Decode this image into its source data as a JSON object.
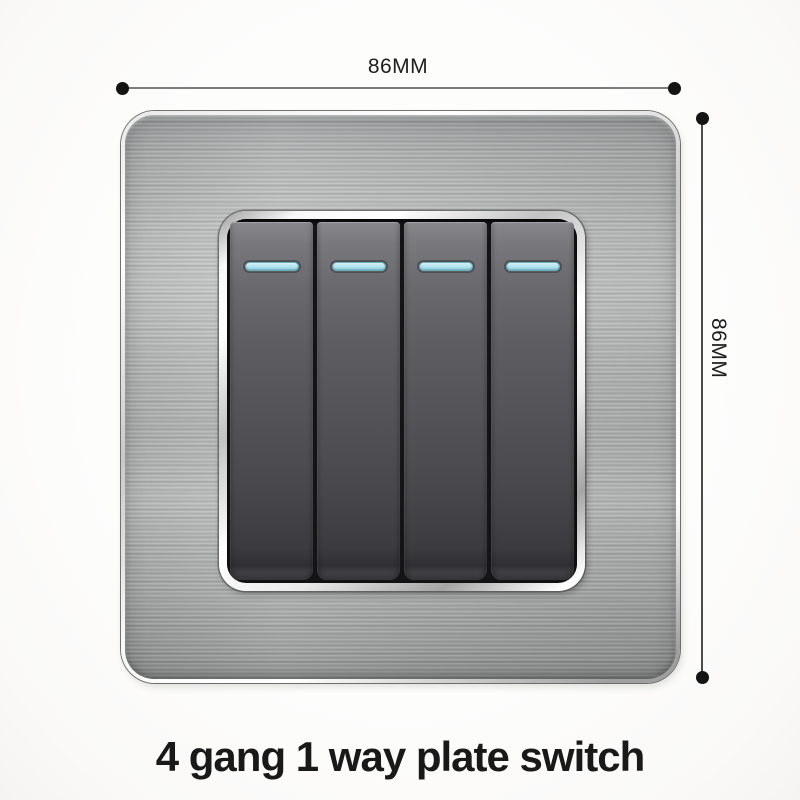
{
  "annotations": {
    "width_label": "86MM",
    "height_label": "86MM"
  },
  "product": {
    "caption": "4 gang 1 way plate switch",
    "gang_count": 4
  },
  "colors": {
    "background": "#fdfdfc",
    "caption_text": "#191919",
    "dimension_text": "#1d1d1d",
    "dimension_line_horizontal": "#7c7c7c",
    "dimension_line_vertical": "#4c4c4c",
    "endpoint_dot": "#141414",
    "plate_steel": "#b9bbba",
    "bezel_chrome": "#f2f2f2",
    "rocker_grey": "#55555a",
    "indicator_cyan": "#a5dfeb"
  }
}
